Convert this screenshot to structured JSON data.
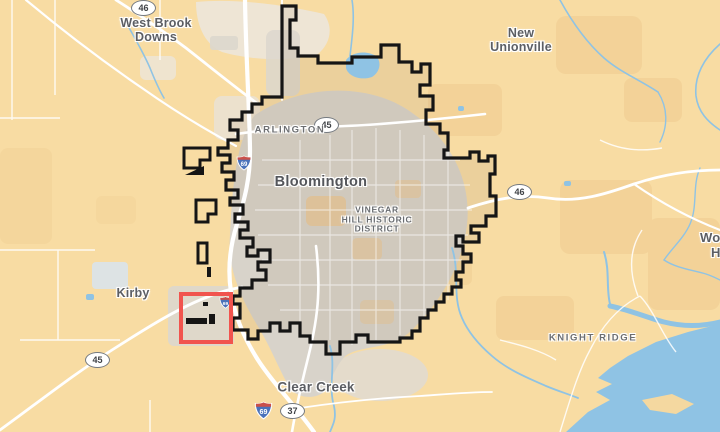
{
  "map": {
    "type": "styled-road-map",
    "labels": {
      "west_brook_downs": {
        "lines": [
          "West Brook",
          "Downs"
        ]
      },
      "new_unionville": {
        "lines": [
          "New",
          "Unionville"
        ]
      },
      "arlington": {
        "text": "ARLINGTON"
      },
      "bloomington": {
        "text": "Bloomington"
      },
      "vinegar_hill": {
        "lines": [
          "VINEGAR",
          "HILL HISTORIC",
          "DISTRICT"
        ]
      },
      "kirby": {
        "text": "Kirby"
      },
      "knight_ridge": {
        "text": "KNIGHT RIDGE"
      },
      "clear_creek": {
        "text": "Clear Creek"
      },
      "edge_partial": {
        "lines": [
          "Wo",
          "H"
        ]
      }
    },
    "shields": {
      "route_46_nw": "46",
      "route_45_north": "45",
      "route_46_east": "46",
      "route_45_southwest": "45",
      "route_37": "37",
      "interstate_69_south": "69",
      "interstate_69_west": "69",
      "interstate_69_small": "69"
    },
    "annotations": {
      "highlight_rectangle": {
        "color": "#f1544e",
        "x": 182,
        "y": 294,
        "width": 50,
        "height": 49
      }
    },
    "colors": {
      "land": "#f8dca3",
      "land_dark": "#eecb90",
      "urban": "#d8d3ca",
      "suburb_light": "#ece6da",
      "water": "#8fc3e4",
      "quarry_pond": "#dde3e4",
      "road": "#ffffff",
      "city_boundary": "#151515",
      "label_text": "#5c5e63"
    }
  }
}
